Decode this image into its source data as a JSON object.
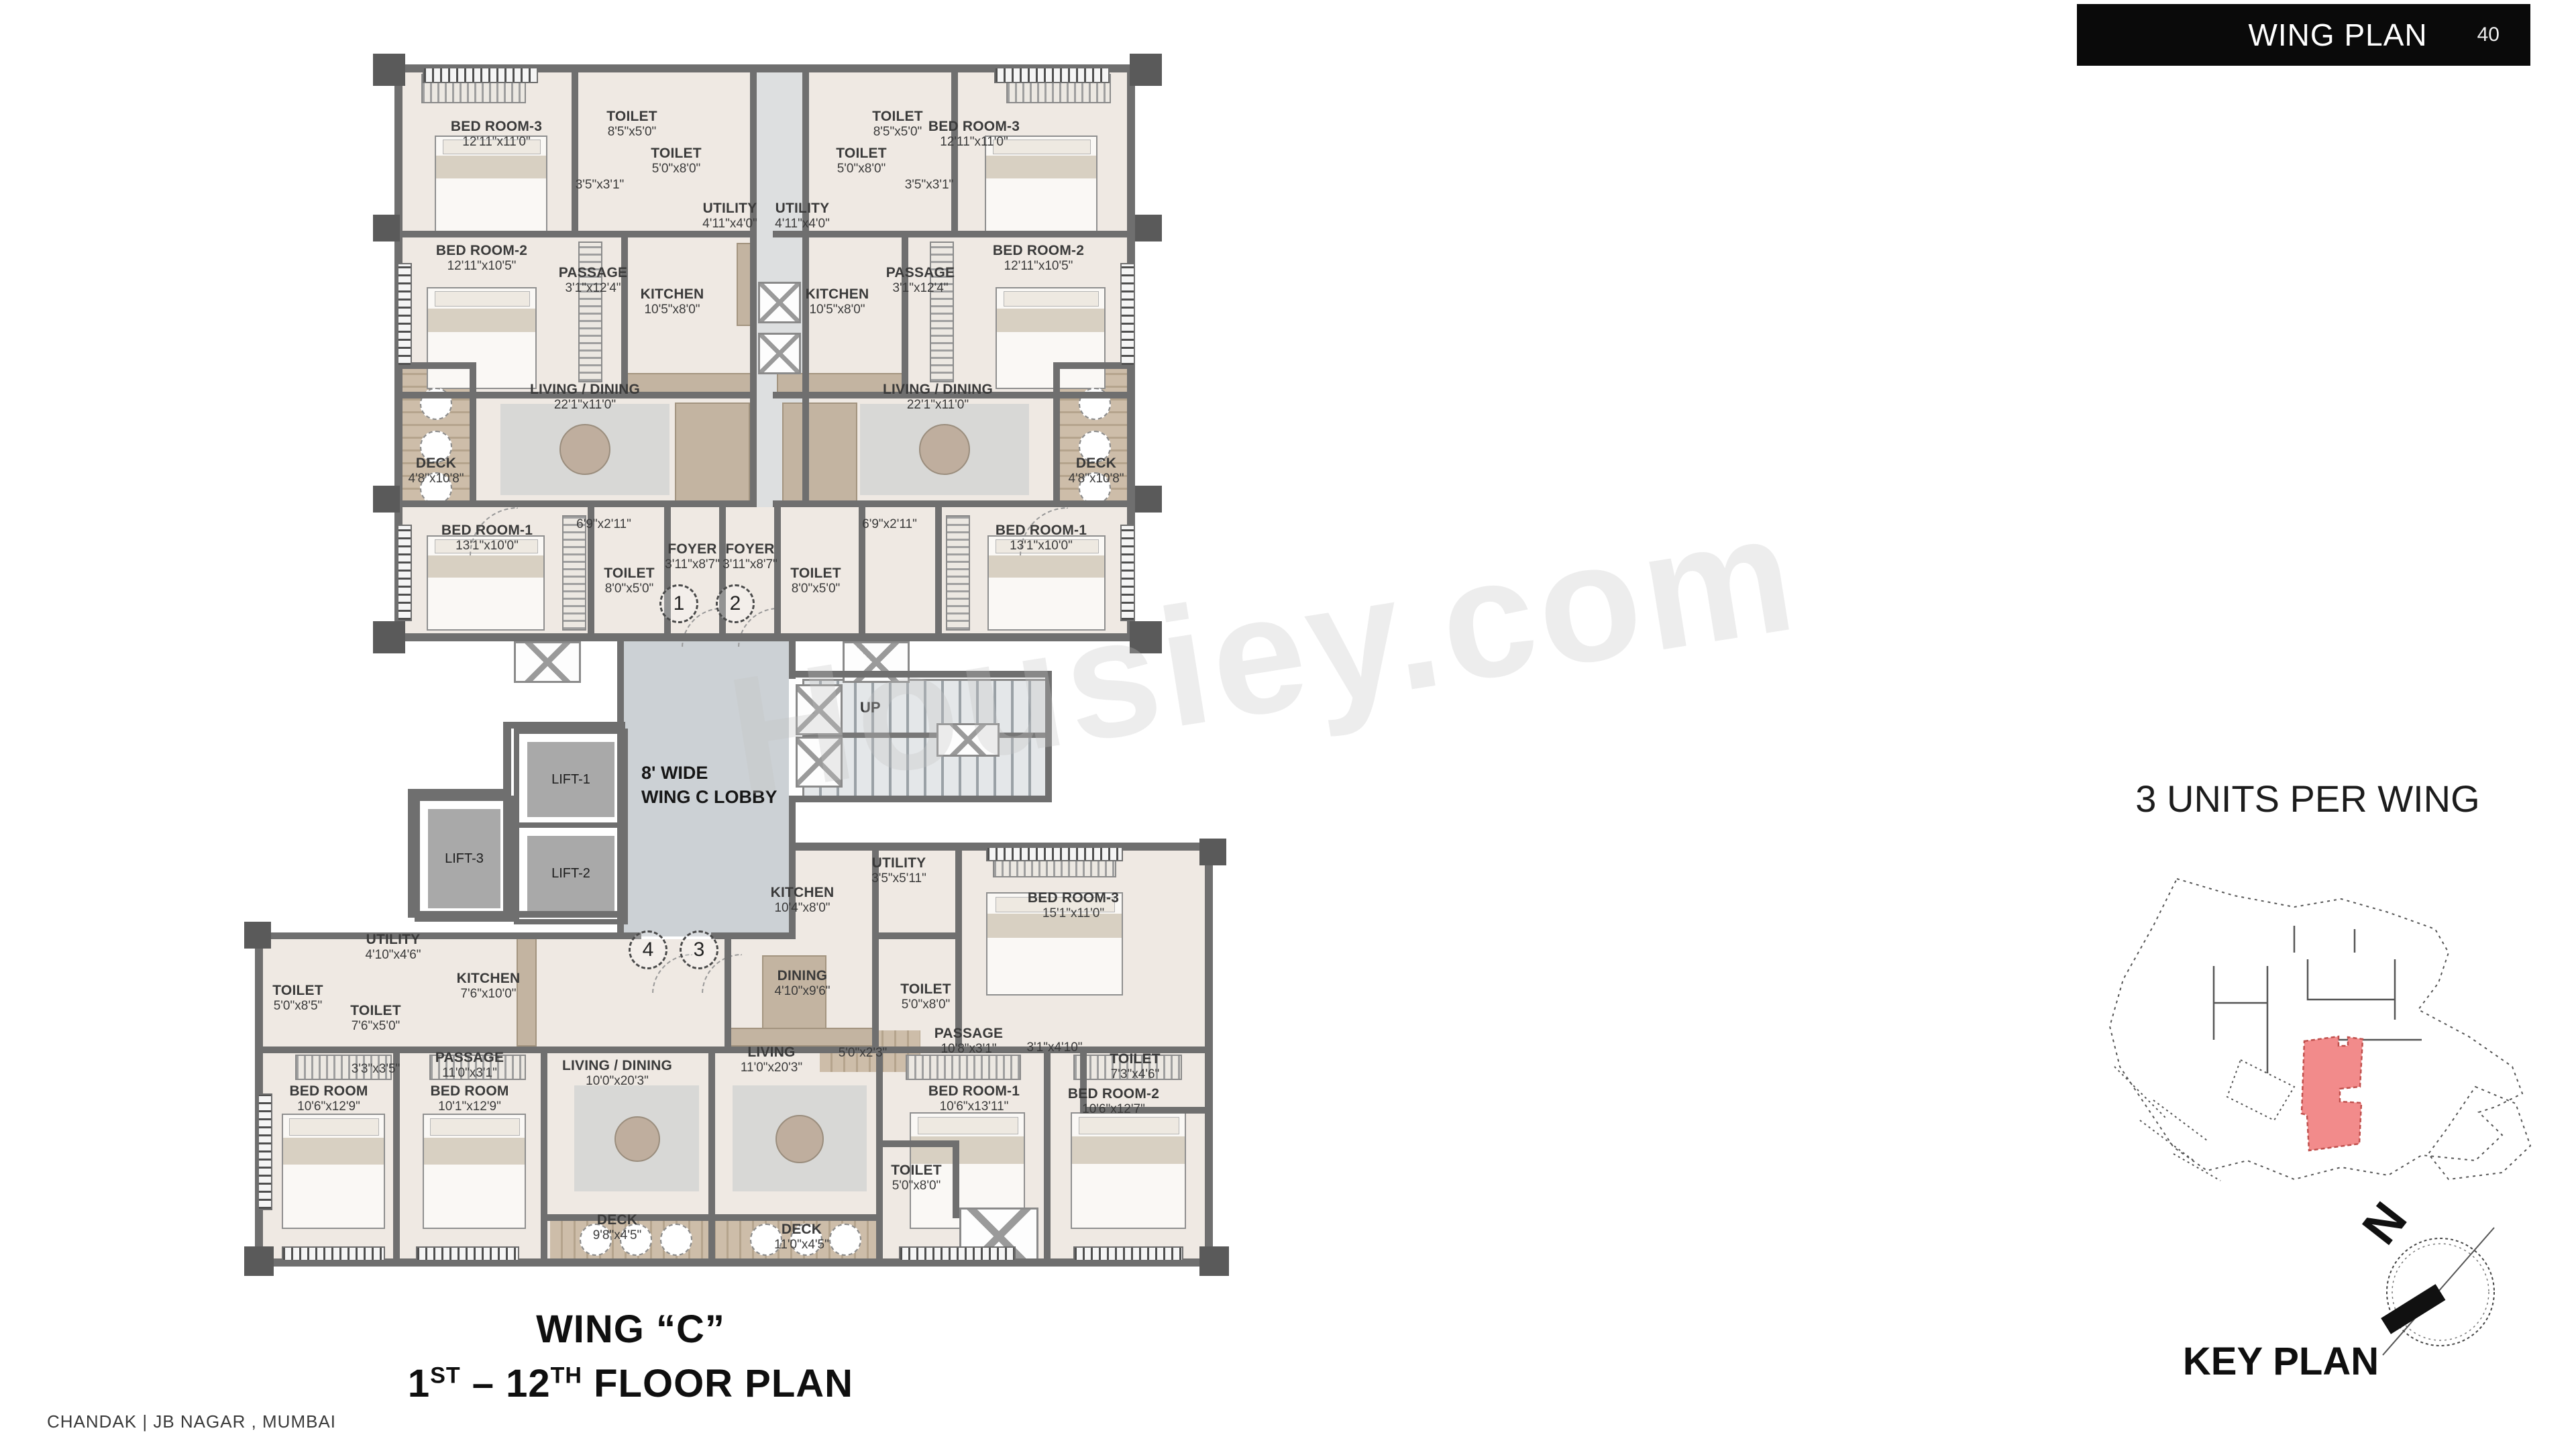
{
  "header": {
    "title": "WING PLAN",
    "page": "40"
  },
  "watermark": "Housiey.com",
  "plan": {
    "lobby_line1": "8' WIDE",
    "lobby_line2": "WING C LOBBY",
    "up": "UP",
    "lifts": [
      "LIFT-1",
      "LIFT-2",
      "LIFT-3"
    ],
    "entries": [
      "1",
      "2",
      "3",
      "4"
    ],
    "rooms": [
      {
        "n": "BED ROOM-3",
        "d": "12'11\"x11'0\""
      },
      {
        "n": "TOILET",
        "d": "8'5\"x5'0\""
      },
      {
        "n": "TOILET",
        "d": "5'0\"x8'0\""
      },
      {
        "n": "",
        "d": "3'5\"x3'1\""
      },
      {
        "n": "UTILITY",
        "d": "4'11\"x4'0\""
      },
      {
        "n": "BED ROOM-2",
        "d": "12'11\"x10'5\""
      },
      {
        "n": "PASSAGE",
        "d": "3'1\"x12'4\""
      },
      {
        "n": "KITCHEN",
        "d": "10'5\"x8'0\""
      },
      {
        "n": "LIVING / DINING",
        "d": "22'1\"x11'0\""
      },
      {
        "n": "DECK",
        "d": "4'8\"x10'8\""
      },
      {
        "n": "BED ROOM-1",
        "d": "13'1\"x10'0\""
      },
      {
        "n": "",
        "d": "6'9\"x2'11\""
      },
      {
        "n": "FOYER",
        "d": "3'11\"x8'7\""
      },
      {
        "n": "TOILET",
        "d": "8'0\"x5'0\""
      },
      {
        "n": "TOILET",
        "d": "8'5\"x5'0\""
      },
      {
        "n": "BED ROOM-3",
        "d": "12'11\"x11'0\""
      },
      {
        "n": "TOILET",
        "d": "5'0\"x8'0\""
      },
      {
        "n": "",
        "d": "3'5\"x3'1\""
      },
      {
        "n": "UTILITY",
        "d": "4'11\"x4'0\""
      },
      {
        "n": "BED ROOM-2",
        "d": "12'11\"x10'5\""
      },
      {
        "n": "PASSAGE",
        "d": "3'1\"x12'4\""
      },
      {
        "n": "KITCHEN",
        "d": "10'5\"x8'0\""
      },
      {
        "n": "LIVING / DINING",
        "d": "22'1\"x11'0\""
      },
      {
        "n": "DECK",
        "d": "4'8\"x10'8\""
      },
      {
        "n": "BED ROOM-1",
        "d": "13'1\"x10'0\""
      },
      {
        "n": "",
        "d": "6'9\"x2'11\""
      },
      {
        "n": "FOYER",
        "d": "3'11\"x8'7\""
      },
      {
        "n": "TOILET",
        "d": "8'0\"x5'0\""
      },
      {
        "n": "KITCHEN",
        "d": "10'4\"x8'0\""
      },
      {
        "n": "UTILITY",
        "d": "3'5\"x5'11\""
      },
      {
        "n": "BED ROOM-3",
        "d": "15'1\"x11'0\""
      },
      {
        "n": "DINING",
        "d": "4'10\"x9'6\""
      },
      {
        "n": "TOILET",
        "d": "5'0\"x8'0\""
      },
      {
        "n": "PASSAGE",
        "d": "10'8\"x3'1\""
      },
      {
        "n": "",
        "d": "3'1\"x4'10\""
      },
      {
        "n": "TOILET",
        "d": "7'3\"x4'6\""
      },
      {
        "n": "",
        "d": "5'0\"x2'3\""
      },
      {
        "n": "UTILITY",
        "d": "4'10\"x4'6\""
      },
      {
        "n": "KITCHEN",
        "d": "7'6\"x10'0\""
      },
      {
        "n": "TOILET",
        "d": "5'0\"x8'5\""
      },
      {
        "n": "TOILET",
        "d": "7'6\"x5'0\""
      },
      {
        "n": "",
        "d": "3'3\"x3'5\""
      },
      {
        "n": "PASSAGE",
        "d": "11'0\"x3'1\""
      },
      {
        "n": "BED ROOM",
        "d": "10'6\"x12'9\""
      },
      {
        "n": "BED ROOM",
        "d": "10'1\"x12'9\""
      },
      {
        "n": "LIVING / DINING",
        "d": "10'0\"x20'3\""
      },
      {
        "n": "LIVING",
        "d": "11'0\"x20'3\""
      },
      {
        "n": "DECK",
        "d": "9'8\"x4'5\""
      },
      {
        "n": "DECK",
        "d": "11'0\"x4'5\""
      },
      {
        "n": "TOILET",
        "d": "5'0\"x8'0\""
      },
      {
        "n": "BED ROOM-1",
        "d": "10'6\"x13'11\""
      },
      {
        "n": "BED ROOM-2",
        "d": "10'6\"x12'7\""
      }
    ]
  },
  "titles": {
    "wing": "WING “C”",
    "floor": {
      "a": "1",
      "asup": "ST",
      "mid": " – ",
      "b": "12",
      "bsup": "TH",
      "rest": " FLOOR PLAN"
    }
  },
  "key_plan": {
    "note": "3 UNITS PER WING",
    "label": "KEY PLAN",
    "north": "N"
  },
  "footer": "CHANDAK | JB NAGAR , MUMBAI"
}
